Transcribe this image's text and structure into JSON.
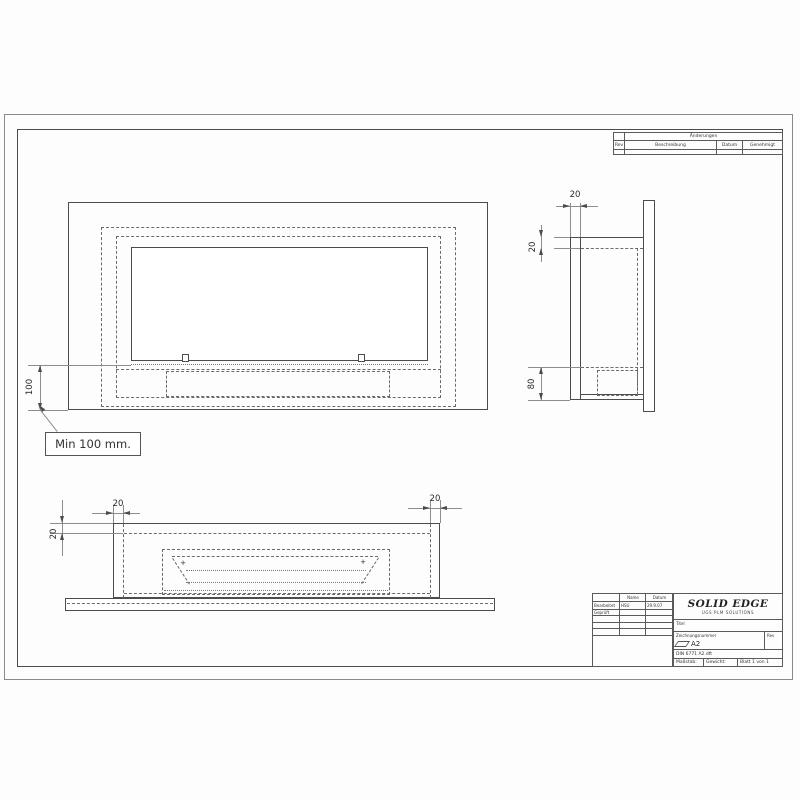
{
  "revision_table": {
    "title": "Änderungen",
    "col_rev": "Rev",
    "col_beschreibung": "Beschreibung",
    "col_datum": "Datum",
    "col_genehmigt": "Genehmigt"
  },
  "title_block": {
    "col_name": "Name",
    "col_datum": "Datum",
    "row_bearbeitet": "Bearbeitet",
    "bearbeitet_name": "HSU",
    "bearbeitet_datum": "29.9.07",
    "row_geprueft": "Geprüft",
    "logo_title": "SOLID EDGE",
    "logo_subtitle": "UGS PLM SOLUTIONS",
    "titel_label": "Titel",
    "number_label": "Zeichnungsnummer",
    "sheet_size": "A2",
    "rev_label": "Rev",
    "filename": "DIN 6771 A2.dft",
    "massstab_label": "Maßstab:",
    "gewicht_label": "Gewicht:",
    "blatt_label": "Blatt 1 von 1"
  },
  "dimensions": {
    "front_height": "100",
    "front_note": "Min 100 mm.",
    "side_depth": "20",
    "side_top_wall": "20",
    "side_burner_height": "80",
    "bottom_wall_left": "20",
    "bottom_wall_right": "20",
    "bottom_front_wall": "20"
  },
  "marks": {
    "plus": "+"
  }
}
